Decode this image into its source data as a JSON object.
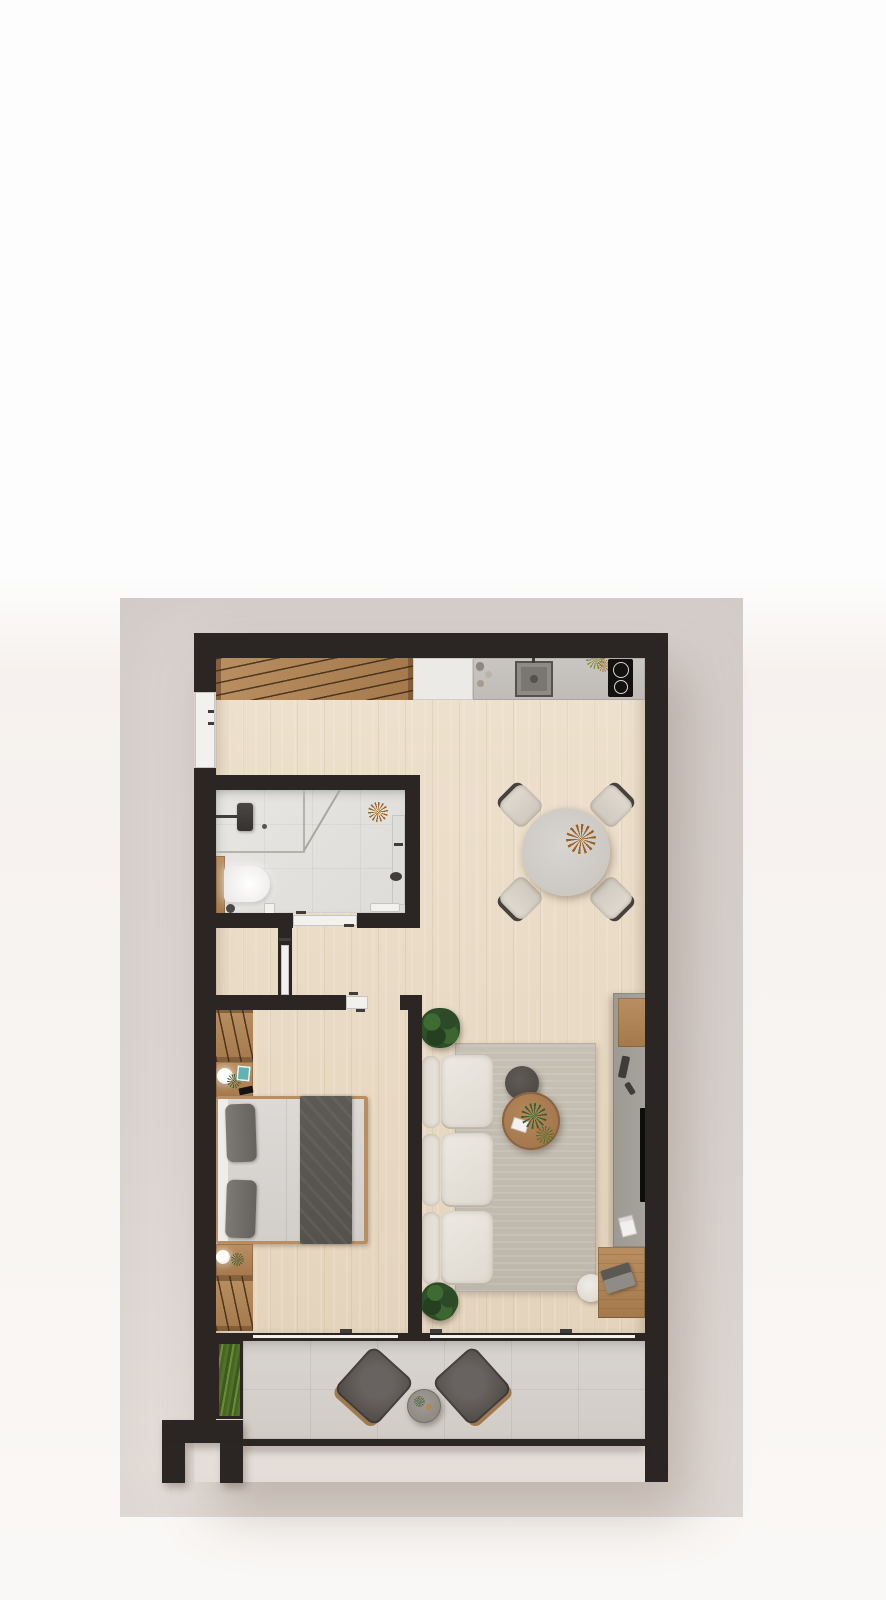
{
  "meta": {
    "view": "apartment-floor-plan-top-down-render",
    "style": "photoreal 3D plan on gray backdrop, no text labels visible"
  },
  "palette": {
    "wall": "#2b2623",
    "glass": "#f3f1ee",
    "metal": "#3f3c39",
    "wood_floor_light": "#eee1cd",
    "wood_floor_dark": "#e4d4bd",
    "wood_furniture": "#b98e60",
    "wood_furniture_dark": "#a47a4c",
    "bathroom_tile": "#e8e6e3",
    "balcony_tile": "#d8d4cf",
    "counter": "#c9c6c1",
    "cabinet_white": "#eceae7",
    "sofa_cream": "#ebe7e0",
    "rug": "#c6bfb4",
    "ottoman_gray": "#534e49",
    "blanket_charcoal": "#55514d",
    "pillow_gray": "#74706c",
    "mattress_gray": "#dcd9d6",
    "tv_unit_gray": "#a6a29c",
    "plant_green": "#2e5128",
    "grass_green": "#51702a",
    "accent_teal": "#5fb3b3",
    "dried_flower_brown": "#9a6228",
    "backdrop_gray": "#d9d2ce",
    "page_white": "#fdfdfd"
  },
  "rooms": [
    {
      "name": "entry-hall-with-wardrobe"
    },
    {
      "name": "open-kitchen"
    },
    {
      "name": "living-dining-room"
    },
    {
      "name": "bathroom"
    },
    {
      "name": "inner-hallway-closet"
    },
    {
      "name": "bedroom"
    },
    {
      "name": "balcony"
    }
  ],
  "furniture": {
    "kitchen": [
      "built-in-wardrobe-with-hangers",
      "tall-white-cabinet",
      "countertop",
      "sink-with-faucet",
      "two-burner-cooktop",
      "jars",
      "herb-plant"
    ],
    "dining": [
      "round-table",
      "four-chairs",
      "dried-flower-centerpiece"
    ],
    "living": [
      "three-seat-cream-sofa",
      "gray-rug",
      "round-wooden-coffee-table",
      "dark-round-ottoman",
      "tv-sideboard",
      "wall-tv",
      "desk-with-laptop",
      "desk-chair",
      "two-potted-plants",
      "magazine"
    ],
    "bathroom": [
      "walk-in-shower",
      "shower-head",
      "toilet",
      "wooden-shelf",
      "wall-vanity-with-basin",
      "towel",
      "dried-flower"
    ],
    "bedroom": [
      "double-bed-with-dark-throw",
      "two-pillows",
      "two-wardrobes-with-hangers",
      "two-nightstands",
      "lamps",
      "teal-book",
      "phone",
      "small-plants"
    ],
    "balcony": [
      "planter-with-grasses",
      "two-lounge-chairs",
      "round-side-table"
    ],
    "doors": [
      "entrance-door-left-wall",
      "bathroom-sliding-door",
      "closet-pocket-door",
      "bedroom-door",
      "balcony-sliding-glass-doors"
    ]
  }
}
